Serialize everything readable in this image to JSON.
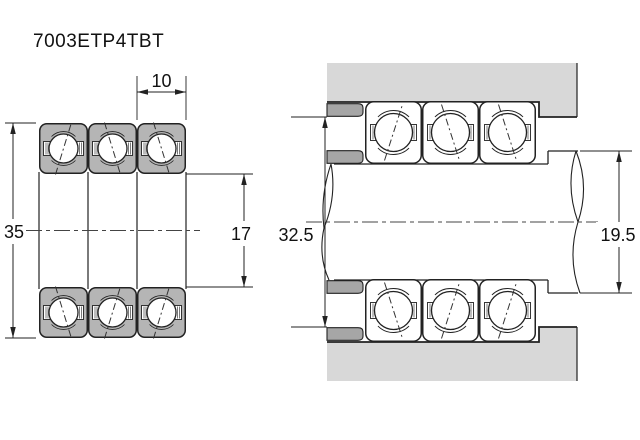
{
  "part_number": "7003ETP4TBT",
  "dimensions": {
    "width": "10",
    "outer_diameter": "35",
    "bore_diameter": "17",
    "housing_shoulder_diameter": "32.5",
    "shaft_shoulder_diameter": "19.5"
  },
  "colors": {
    "background": "#ffffff",
    "bearing_fill": "#b5b5b5",
    "housing_fill": "#d8d8d8",
    "spacer_fill": "#a6a6a6",
    "ball_fill": "#ffffff",
    "line": "#222222"
  }
}
